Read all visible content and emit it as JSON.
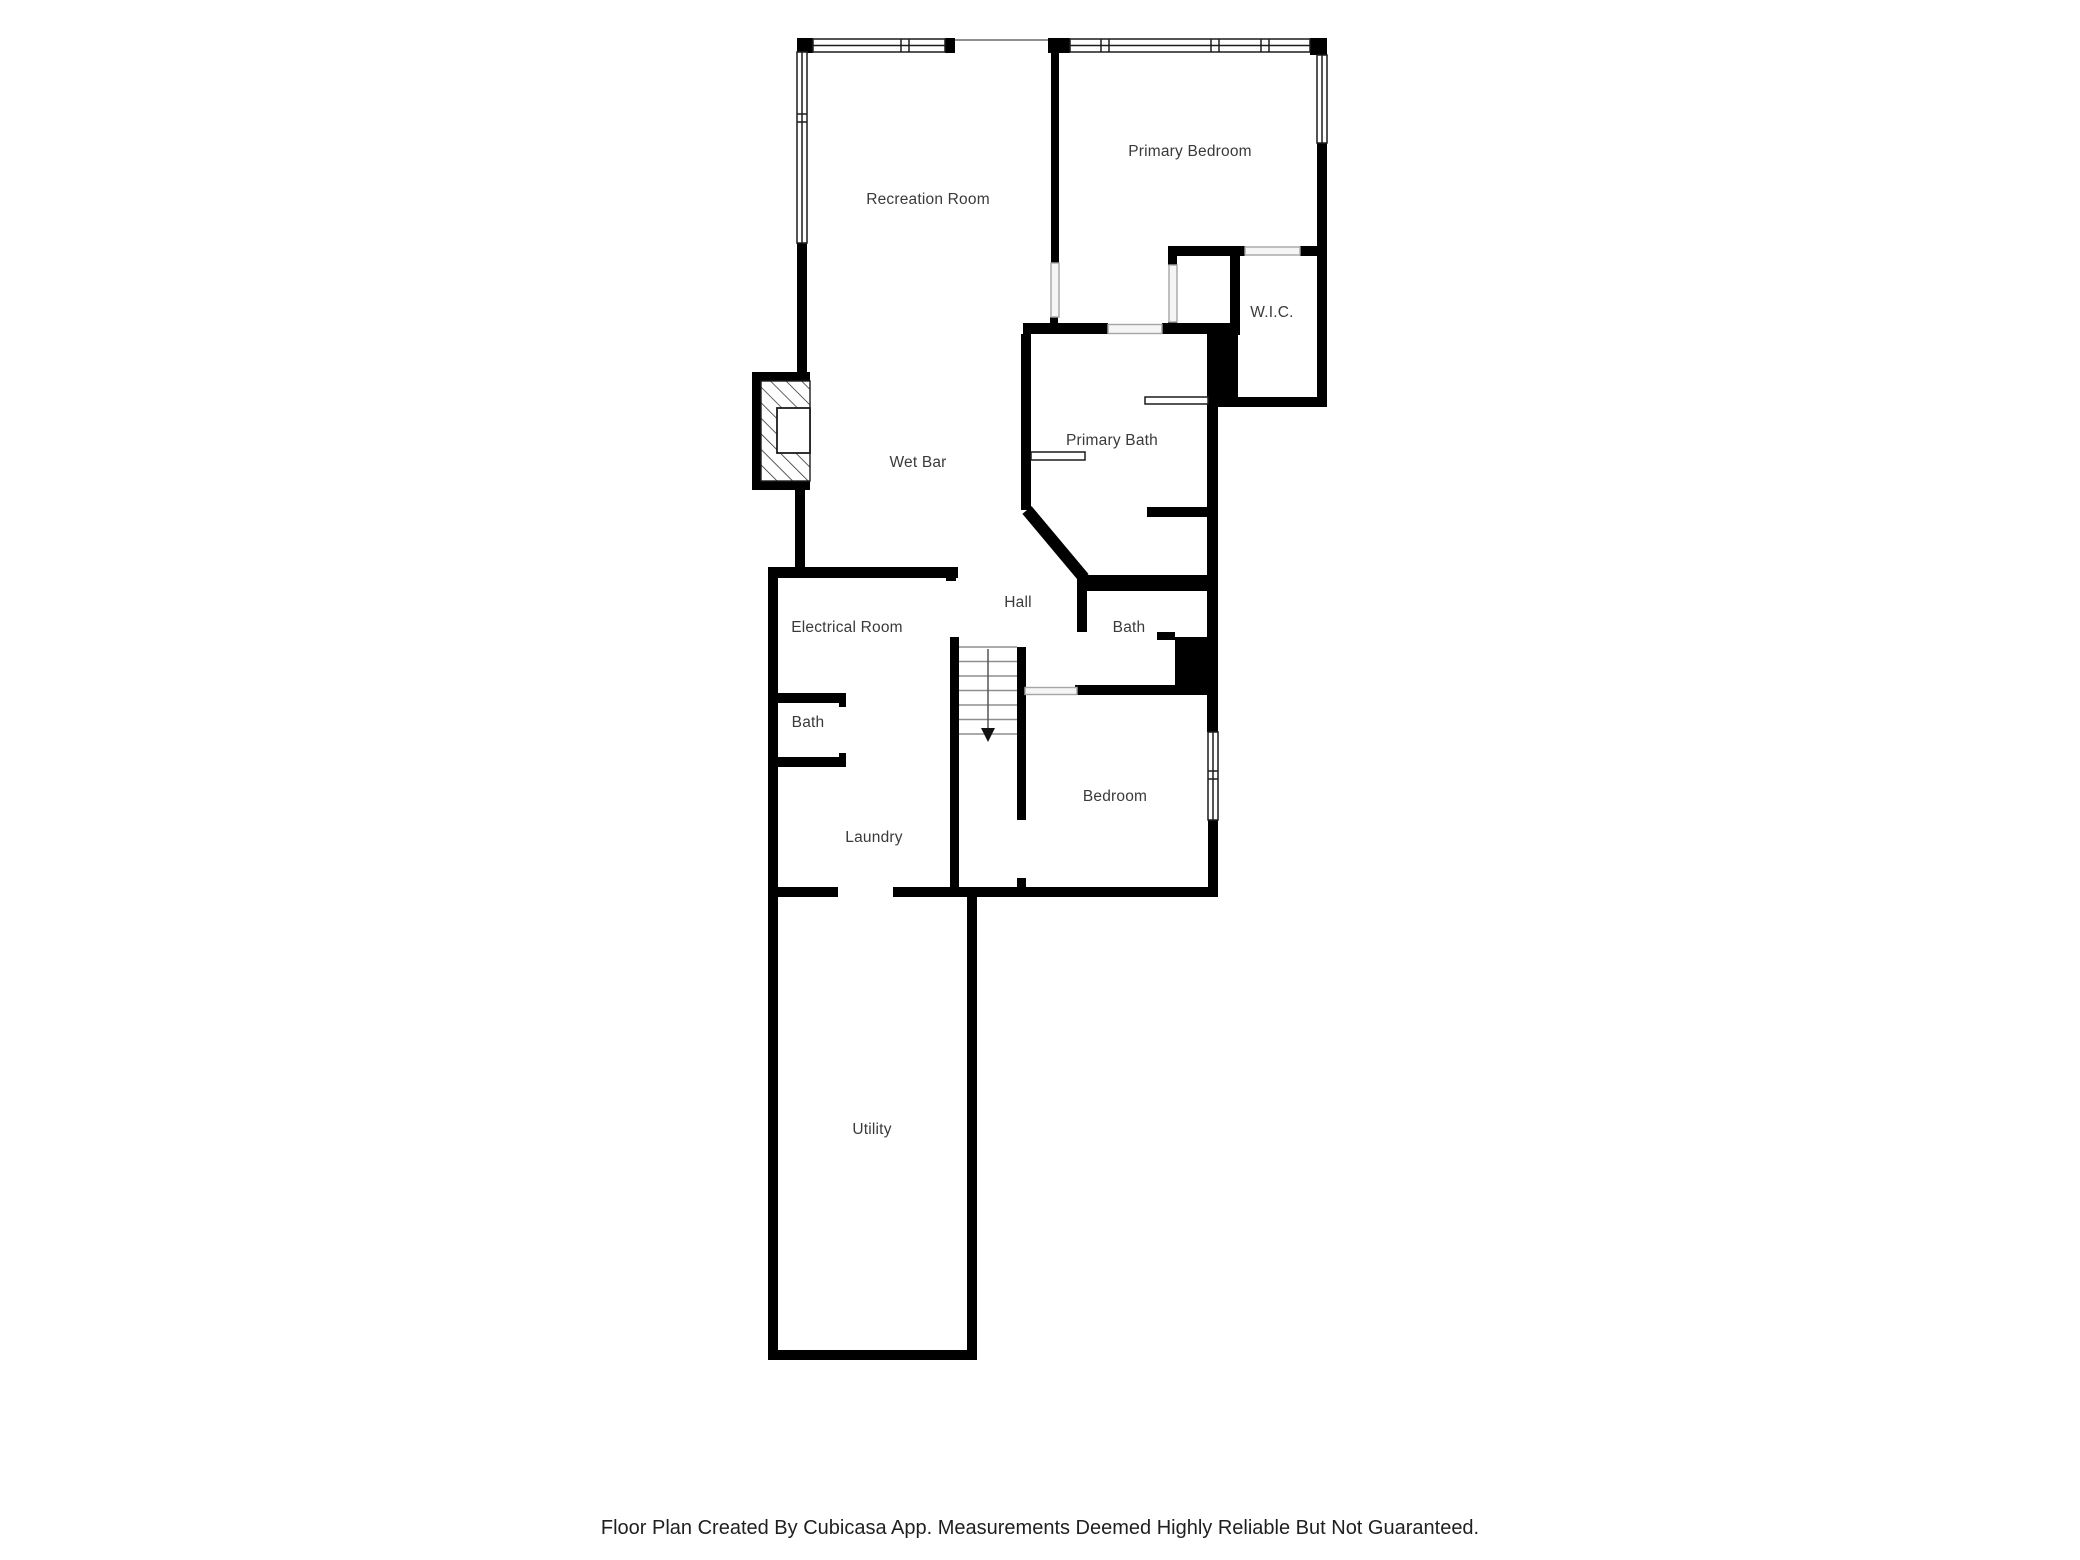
{
  "plan": {
    "type": "floor-plan",
    "creator_note": "Cubicasa App",
    "wall_color": "#000000",
    "background_color": "#ffffff",
    "label_color": "#3a3a3a",
    "stair_line_color": "#8f8f8f"
  },
  "rooms": [
    {
      "label": "Recreation Room",
      "x": 928,
      "y": 200
    },
    {
      "label": "Primary Bedroom",
      "x": 1190,
      "y": 152
    },
    {
      "label": "W.I.C.",
      "x": 1272,
      "y": 313
    },
    {
      "label": "Primary Bath",
      "x": 1112,
      "y": 441
    },
    {
      "label": "Wet Bar",
      "x": 918,
      "y": 463
    },
    {
      "label": "Hall",
      "x": 1018,
      "y": 603
    },
    {
      "label": "Electrical Room",
      "x": 847,
      "y": 628
    },
    {
      "label": "Bath",
      "x": 808,
      "y": 723
    },
    {
      "label": "Bath",
      "x": 1129,
      "y": 628
    },
    {
      "label": "Laundry",
      "x": 874,
      "y": 838
    },
    {
      "label": "Bedroom",
      "x": 1115,
      "y": 797
    },
    {
      "label": "Utility",
      "x": 872,
      "y": 1130
    }
  ],
  "features": {
    "windows": 5,
    "stairs": {
      "direction_arrow": "down"
    },
    "fireplace": true,
    "door_openings": 9
  },
  "footer": {
    "text": "Floor Plan Created By Cubicasa App. Measurements Deemed Highly Reliable But Not Guaranteed."
  }
}
